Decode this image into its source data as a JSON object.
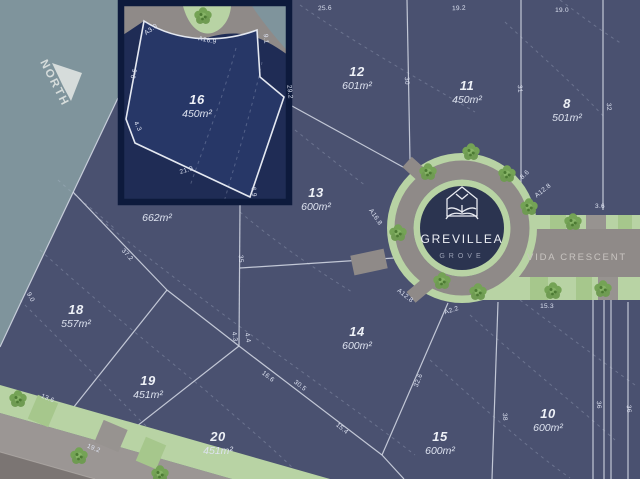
{
  "map": {
    "north_label": "NORTH",
    "street": {
      "name": "VIDA CRESCENT"
    },
    "logo": {
      "title": "GREVILLEA",
      "subtitle": "GROVE"
    },
    "highlighted_lot": {
      "num": "16",
      "area": "450m²"
    },
    "lots": [
      {
        "num": "16",
        "area": "450m²",
        "x": 197,
        "y": 104,
        "highlighted": true
      },
      {
        "num": "12",
        "area": "601m²",
        "x": 357,
        "y": 76
      },
      {
        "num": "11",
        "area": "450m²",
        "x": 467,
        "y": 90
      },
      {
        "num": "8",
        "area": "501m²",
        "x": 567,
        "y": 108
      },
      {
        "num": "13",
        "area": "600m²",
        "x": 316,
        "y": 197
      },
      {
        "num": "",
        "area": "662m²",
        "x": 157,
        "y": 221
      },
      {
        "num": "18",
        "area": "557m²",
        "x": 76,
        "y": 314
      },
      {
        "num": "19",
        "area": "451m²",
        "x": 148,
        "y": 385
      },
      {
        "num": "20",
        "area": "451m²",
        "x": 218,
        "y": 441
      },
      {
        "num": "14",
        "area": "600m²",
        "x": 357,
        "y": 336
      },
      {
        "num": "15",
        "area": "600m²",
        "x": 440,
        "y": 441
      },
      {
        "num": "10",
        "area": "600m²",
        "x": 548,
        "y": 418
      }
    ],
    "dimensions": [
      {
        "t": "A3.0",
        "x": 152,
        "y": 31,
        "r": -36
      },
      {
        "t": "A16.9",
        "x": 207,
        "y": 42,
        "r": 12
      },
      {
        "t": "9.1",
        "x": 264,
        "y": 39,
        "r": 85
      },
      {
        "t": "29.2",
        "x": 288,
        "y": 92,
        "r": 84
      },
      {
        "t": "9.6",
        "x": 136,
        "y": 74,
        "r": -79
      },
      {
        "t": "4.3",
        "x": 136,
        "y": 127,
        "r": 65
      },
      {
        "t": "21.9",
        "x": 187,
        "y": 172,
        "r": -17
      },
      {
        "t": "6.9",
        "x": 252,
        "y": 192,
        "r": 86
      },
      {
        "t": "25.6",
        "x": 325,
        "y": 10,
        "r": -2
      },
      {
        "t": "19.2",
        "x": 459,
        "y": 10,
        "r": -2
      },
      {
        "t": "19.0",
        "x": 562,
        "y": 12,
        "r": 0
      },
      {
        "t": "30",
        "x": 405,
        "y": 81,
        "r": 86
      },
      {
        "t": "31",
        "x": 518,
        "y": 89,
        "r": 86
      },
      {
        "t": "32",
        "x": 607,
        "y": 107,
        "r": 86
      },
      {
        "t": "A16.8",
        "x": 374,
        "y": 218,
        "r": 55
      },
      {
        "t": "A12.8",
        "x": 404,
        "y": 297,
        "r": 38
      },
      {
        "t": "A2.2",
        "x": 452,
        "y": 312,
        "r": -18
      },
      {
        "t": "8.6",
        "x": 526,
        "y": 176,
        "r": -44
      },
      {
        "t": "A12.8",
        "x": 544,
        "y": 192,
        "r": -38
      },
      {
        "t": "3.6",
        "x": 600,
        "y": 208,
        "r": 0
      },
      {
        "t": "15.3",
        "x": 547,
        "y": 308,
        "r": 0
      },
      {
        "t": "35",
        "x": 239,
        "y": 259,
        "r": 86
      },
      {
        "t": "37.2",
        "x": 126,
        "y": 256,
        "r": 47
      },
      {
        "t": "9.0",
        "x": 29,
        "y": 298,
        "r": 62
      },
      {
        "t": "4.3",
        "x": 233,
        "y": 337,
        "r": 80
      },
      {
        "t": "4.4",
        "x": 246,
        "y": 338,
        "r": 80
      },
      {
        "t": "16.6",
        "x": 267,
        "y": 378,
        "r": 38
      },
      {
        "t": "30.5",
        "x": 299,
        "y": 387,
        "r": 38
      },
      {
        "t": "32.6",
        "x": 420,
        "y": 381,
        "r": -69
      },
      {
        "t": "15.4",
        "x": 341,
        "y": 430,
        "r": 40
      },
      {
        "t": "13.6",
        "x": 47,
        "y": 400,
        "r": 22
      },
      {
        "t": "19.2",
        "x": 93,
        "y": 450,
        "r": 22
      },
      {
        "t": "38",
        "x": 503,
        "y": 417,
        "r": 86
      },
      {
        "t": "36",
        "x": 597,
        "y": 405,
        "r": 86
      },
      {
        "t": "36",
        "x": 627,
        "y": 409,
        "r": 86
      }
    ],
    "colors": {
      "lot_fill": "#4a5170",
      "highlight_fill": "#243363",
      "highlight_border": "#0d1a3c",
      "outside_area": "#7f949c",
      "road": "#8f8a88",
      "verge_green": "#b8d3a4",
      "tree_green": "#6f9b52",
      "logo_circle": "#2b3450",
      "boundary_line": "#d7dce8"
    }
  }
}
